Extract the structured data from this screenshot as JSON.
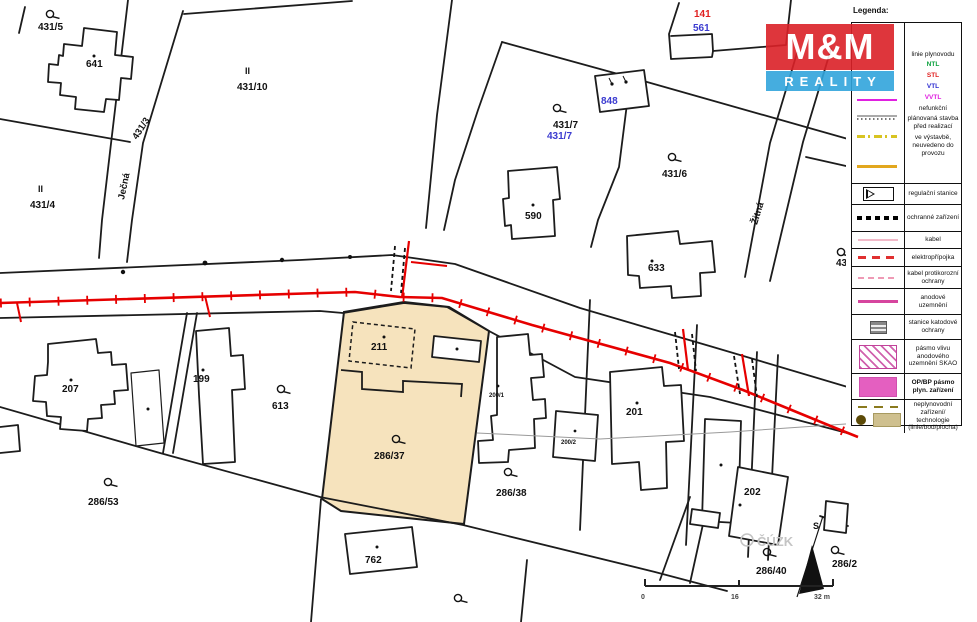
{
  "logo": {
    "top": "M&M",
    "bottom": "REALITY"
  },
  "legend": {
    "title": "Legenda:",
    "gas": {
      "header": "linie plynovodu",
      "ntl": "NTL",
      "stl": "STL",
      "vtl": "VTL",
      "vvtl": "VVTL",
      "nefunkcni": "nefunkční",
      "planovana": "plánovaná stavba před realizací",
      "vystavba": "ve výstavbě, neuvedeno do provozu"
    },
    "rows": [
      {
        "label": "regulační stanice"
      },
      {
        "label": "ochranné zařízení"
      },
      {
        "label": "kabel"
      },
      {
        "label": "elektropřípojka"
      },
      {
        "label": "kabel protikorozní ochrany"
      },
      {
        "label": "anodové uzemnění"
      },
      {
        "label": "stanice katodové ochrany"
      },
      {
        "label": "pásmo vlivu anodového uzemnění SKAO"
      },
      {
        "label": "OP/BP pásmo plyn. zařízení"
      },
      {
        "label": "neplynovodní zařízení/ technologie (linie/bod/plocha)"
      }
    ]
  },
  "map": {
    "labels": {
      "p431_5": "431/5",
      "b641": "641",
      "roman_10": "II",
      "p431_10": "431/10",
      "p431_3": "431/3",
      "jecna": "Ječná",
      "roman_4": "II",
      "p431_4": "431/4",
      "r141": "141",
      "b561": "561",
      "b848": "848",
      "p431_7": "431/7",
      "p431_7b": "431/7",
      "b590": "590",
      "p431_6": "431/6",
      "b633": "633",
      "zitna": "Žitná",
      "b207": "207",
      "b199": "199",
      "p613": "613",
      "b211": "211",
      "p286_37": "286/37",
      "b200_1": "200/1",
      "b200_2": "200/2",
      "p286_38": "286/38",
      "b201": "201",
      "b202": "202",
      "p286_53": "286/53",
      "b762": "762",
      "p286_40": "286/40",
      "p286_2": "286/2",
      "p43": "43"
    },
    "watermark": "ČÚZK",
    "north_label": "S",
    "scalebar": {
      "zero": "0",
      "mid": "16",
      "end": "32 m"
    }
  },
  "colors": {
    "highlight_parcel": "#f6e3bd",
    "pipeline_red": "#e60000",
    "parcel_line": "#1c1c1c",
    "label_blue": "#3b3bd0",
    "label_red": "#e02020",
    "legend_ntl_green": "#0aa13c",
    "legend_stl_red": "#e02020",
    "legend_vtl_blue": "#2b2bd0",
    "legend_vvtl_magenta": "#e020e0",
    "logo_red": "#db2128",
    "logo_blue": "#31a5dc"
  }
}
